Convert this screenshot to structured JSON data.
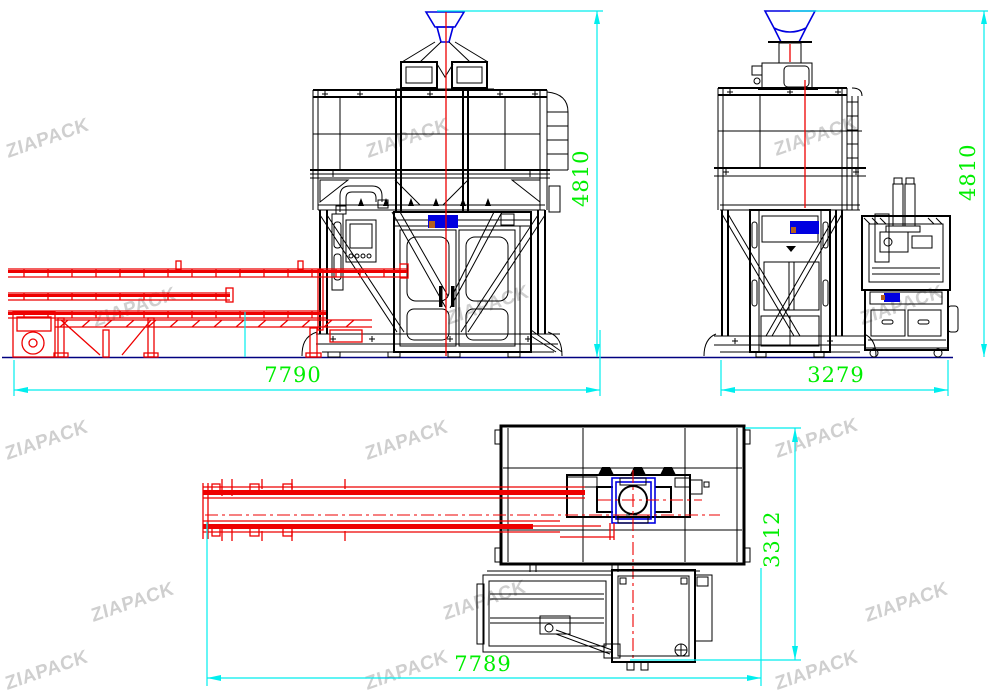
{
  "brand": {
    "watermark": "ZIAPACK"
  },
  "views": {
    "front": {
      "width": "7790",
      "height": "4810"
    },
    "side": {
      "width": "3279",
      "height": "4810"
    },
    "plan": {
      "length": "7789",
      "depth": "3312"
    }
  },
  "colors": {
    "line": "#000000",
    "conveyor": "#ee0000",
    "dimension": "#00eeee",
    "dim_text": "#00ee00",
    "accent_blue": "#0000e0",
    "ground": "#000080",
    "watermark": "#c9c9c9",
    "logo_orange": "#b4601e",
    "background": "#ffffff"
  }
}
